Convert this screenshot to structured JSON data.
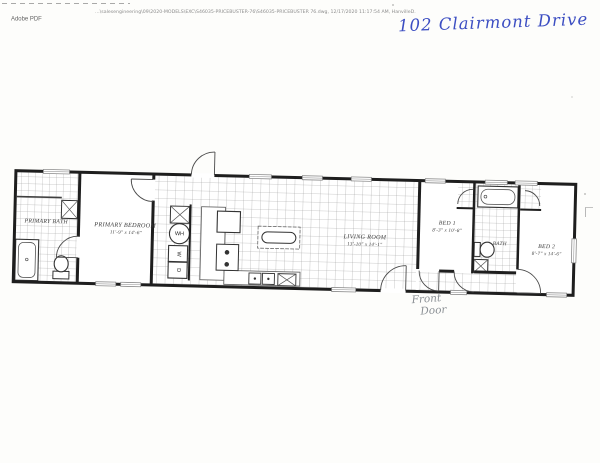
{
  "header": {
    "path_line": "…\\salesengineering\\09\\2020-MODELS\\EXC\\S46035-PRICEBUSTER-76\\S46035-PRICEBUSTER 76.dwg, 12/17/2020 11:17:54 AM, HanvilleD.",
    "app_label": "Adobe PDF"
  },
  "annotations": {
    "address": "102 Clairmont Drive",
    "front_door_line1": "Front",
    "front_door_line2": "Door"
  },
  "rooms": {
    "primary_bath": {
      "name": "PRIMARY BATH"
    },
    "primary_bedroom": {
      "name": "PRIMARY BEDROOM",
      "dims": "11'-9\" x 14'-6\""
    },
    "living_room": {
      "name": "LIVING ROOM",
      "dims": "13'-10\" x 14'-1\""
    },
    "bed1": {
      "name": "BED 1",
      "dims": "8'-3\" x 10'-8\""
    },
    "bath": {
      "name": "BATH"
    },
    "bed2": {
      "name": "BED 2",
      "dims": "8'-7\" x 14'-6\""
    }
  },
  "appliances": {
    "water_heater": "WH",
    "washer": "W",
    "dryer": "D"
  },
  "colors": {
    "ink_blue": "#3c4ec2",
    "pencil_gray": "#8a8f94",
    "wall_black": "#1e1e1e"
  }
}
